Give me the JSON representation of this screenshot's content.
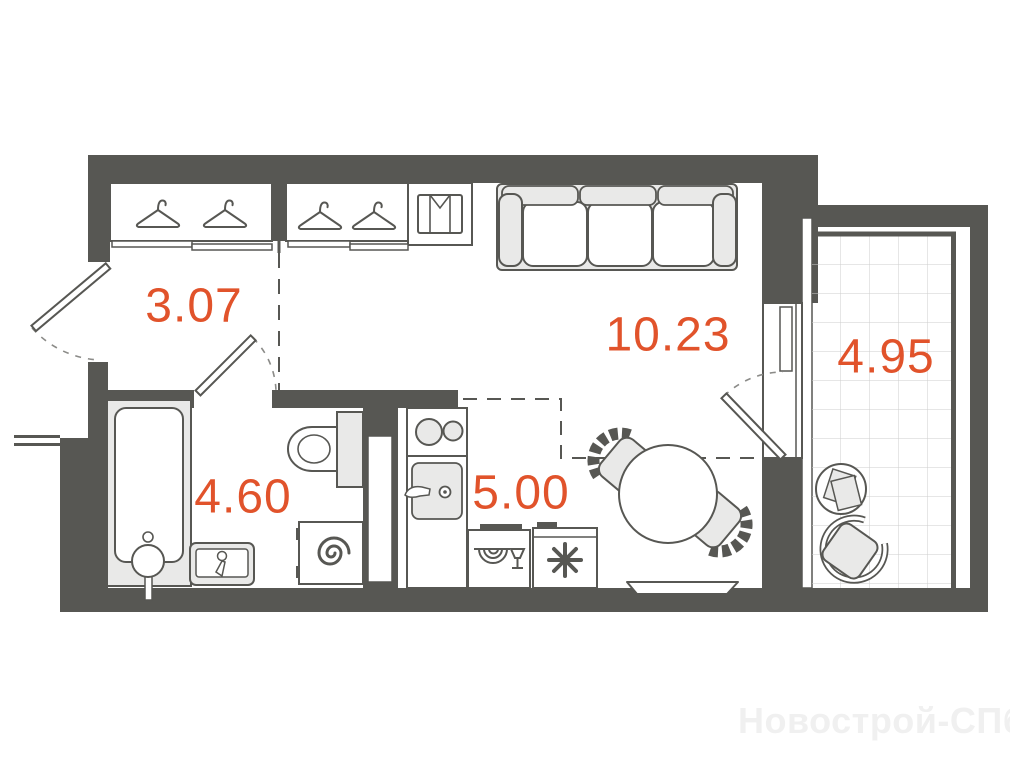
{
  "plan": {
    "type": "apartment-floor-plan",
    "watermark": "Новострой-СПб",
    "rooms": [
      {
        "name": "hallway",
        "area_label": "3.07"
      },
      {
        "name": "living-room",
        "area_label": "10.23"
      },
      {
        "name": "bathroom",
        "area_label": "4.60"
      },
      {
        "name": "kitchen",
        "area_label": "5.00"
      },
      {
        "name": "balcony",
        "area_label": "4.95"
      }
    ],
    "colors": {
      "wall": "#575753",
      "area_label": "#e1532b",
      "furniture_fill": "#e9e9e8",
      "tile_grid": "#cdcdcc",
      "swing_arc": "#8b8b88",
      "watermark": "#f0f0f0"
    },
    "icons": [
      "hanger-icon",
      "shirt-icon",
      "snowflake-icon",
      "plate-glass-icon",
      "spiral-icon"
    ]
  }
}
